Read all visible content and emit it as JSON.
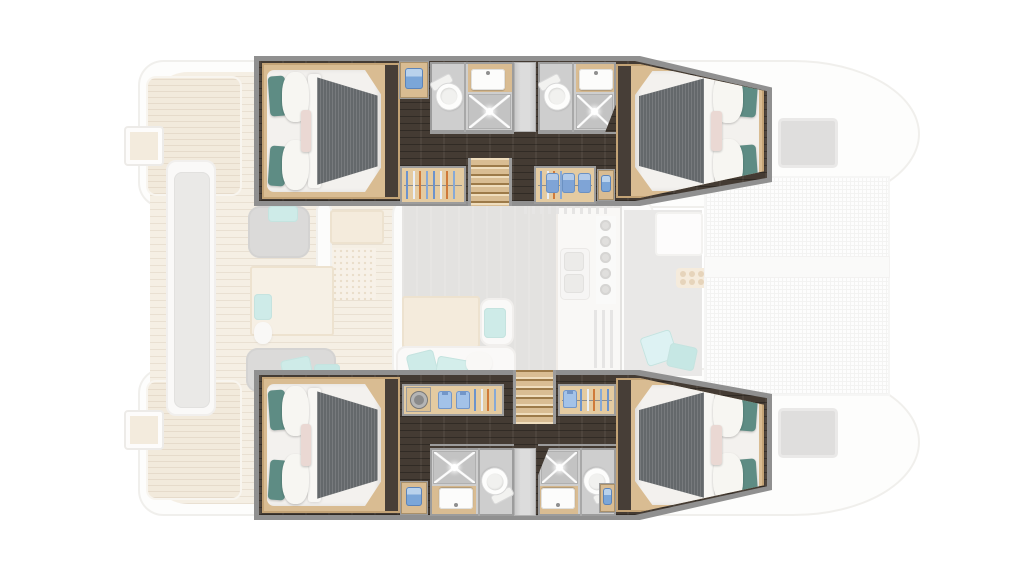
{
  "meta": {
    "title": "Catamaran layout plan — 4 cabin / 4 bathroom version",
    "projection": "top-down floorplan",
    "orientation": {
      "bow": "right",
      "stern": "left",
      "port_hull": "top",
      "starboard_hull": "bottom"
    },
    "highlight_note": "hull accommodations at full opacity; saloon, cockpit and foredeck faded"
  },
  "palette": {
    "canvas": "#ffffff",
    "wall_gray": "#909090",
    "hull_floor_dark_wood": "#443b33",
    "cabin_wood": "#d9bc92",
    "wardrobe_wood": "#e4cba1",
    "stair_wood": "#d9bd93",
    "duvet_gray": "#64686b",
    "mattress_white": "#f3f1ee",
    "pillow_teal": "#5e8c84",
    "pillow_blush": "#ead8d3",
    "bathroom_floor": "#cecece",
    "shower_tray": "#c3c3c3",
    "porcelain_white": "#fdfdfc",
    "vanity_basin_blue": "#7ba6d8",
    "hanger_blue": "#6c93cc",
    "hanger_orange": "#cf7a3a",
    "deck_wood_faded": "#ece0cb",
    "saloon_floor_faded": "#c9c6c2",
    "cushion_gray": "#d6d4d1",
    "cushion_teal": "#9ed8d2",
    "hatch_gray": "#c0bfbd"
  },
  "port_hull": {
    "name": "Port hull accommodations",
    "aft_cabin": "Port aft double cabin",
    "fwd_cabin": "Port forward double cabin",
    "aft_bathroom": "Port aft bathroom: toilet, washbasin, shower",
    "fwd_bathroom": "Port forward bathroom: toilet, washbasin, shower",
    "aft_vanity": "Vanity washbasin",
    "fwd_vanity": "Vanity washbasin",
    "aft_wardrobe": "Hanging wardrobe",
    "fwd_wardrobe": "Wardrobe with hanging rail and shelved clothes",
    "stairs": "Companionway steps to saloon",
    "landing": "Companionway landing"
  },
  "starboard_hull": {
    "name": "Starboard hull accommodations",
    "aft_cabin": "Starboard aft double cabin",
    "fwd_cabin": "Starboard forward double cabin",
    "aft_bathroom": "Starboard aft bathroom: toilet, washbasin, shower",
    "fwd_bathroom": "Starboard forward bathroom: toilet, washbasin, shower",
    "aft_vanity": "Vanity washbasin",
    "fwd_vanity": "Vanity washbasin",
    "utility": "Utility locker: washer, folded clothes, hanging rail",
    "fwd_wardrobe": "Wardrobe with hanging rail",
    "stairs": "Companionway steps to saloon",
    "landing": "Companionway landing"
  },
  "saloon": {
    "name": "Saloon and galley (faded)",
    "floor": "Saloon floor",
    "galley_counter": "Galley counter",
    "sink": "Double galley sink",
    "stove": "Stove with burners",
    "vent": "Vent grille",
    "table": "Dining table",
    "sofa": "Saloon sofa with cushions",
    "side_seat": "Side seat",
    "nav_desk": "Chart desk",
    "rug": "Dotted mat",
    "gray_seat_fwd": "Lounge seat",
    "gray_seat_aft": "Lounge seat"
  },
  "cockpit": {
    "name": "Aft cockpit (faded)",
    "deck": "Teak cockpit deck",
    "bench": "Transom bench with cushion",
    "port_platform": "Port swim platform",
    "stbd_platform": "Starboard swim platform",
    "boarding_step_port": "Boarding step",
    "boarding_step_stbd": "Boarding step",
    "pillows": "Scatter cushions"
  },
  "foredeck": {
    "name": "Foredeck (faded)",
    "trampoline": "Bow trampoline net",
    "crossbeam": "Forward crossbeam",
    "hatch_port": "Deck hatch",
    "hatch_stbd": "Deck hatch",
    "sunpad": "Forward sunpad",
    "tray": "Cockpit tray",
    "walkway": "Forward walkway",
    "pillows": "Scatter cushions"
  }
}
